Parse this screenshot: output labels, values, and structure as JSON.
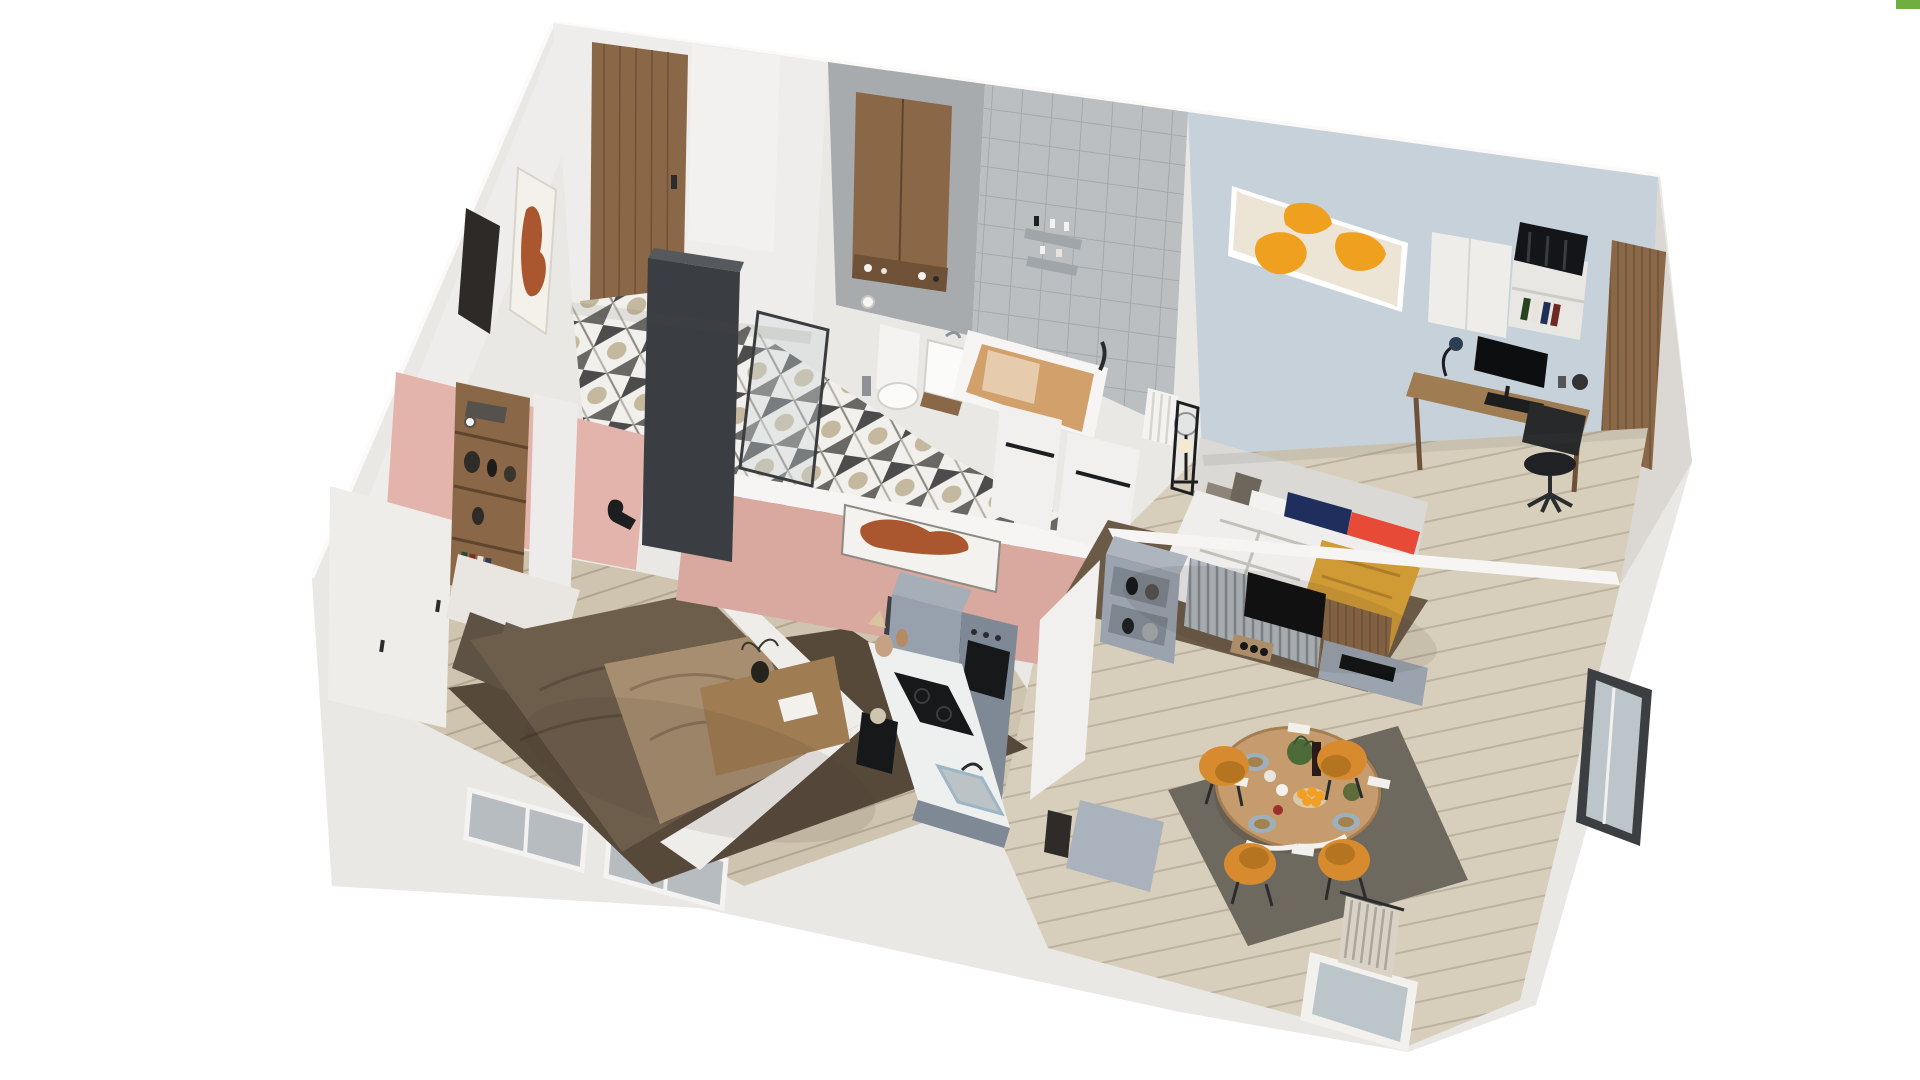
{
  "scene": {
    "type": "isometric-3d-apartment-floor-plan",
    "style": "cutaway-axonometric-interior-render",
    "rooms": [
      {
        "name": "entry-hall",
        "floor": "black-white-geometric-tile",
        "items": [
          "wooden-entry-door",
          "framed-figure-art",
          "mirror-niche",
          "dark-freestanding-wardrobe"
        ]
      },
      {
        "name": "bathroom",
        "items": [
          "wooden-wall-cabinet",
          "toiletries",
          "toilet",
          "paper-roll",
          "washbasin",
          "bathtub-tan-interior",
          "gray-tile-accent-wall",
          "metal-shelves",
          "towel-rail-half-walls",
          "glass-partition",
          "white-radiator"
        ]
      },
      {
        "name": "bedroom-secondary",
        "wall": "light-blue",
        "items": [
          "abstract-orange-wall-art",
          "upholstered-headboard-bed",
          "gray-pillows",
          "navy-pillow",
          "red-pillow",
          "mustard-throw",
          "teddy-bear",
          "glass-bedside-lamp",
          "bronze-rug",
          "wood-desk",
          "monitor",
          "keyboard",
          "desk-lamp",
          "office-chair",
          "white-cabinet",
          "open-bookshelf",
          "black-suitcase",
          "wood-slat-column"
        ]
      },
      {
        "name": "bedroom-master",
        "wall": "blush-pink",
        "items": [
          "white-wardrobes",
          "wooden-shelf-column-with-vases",
          "books",
          "wall-lamp",
          "double-bed-brown-bedding",
          "taupe-throw",
          "brown-pillows",
          "dark-brown-rug",
          "wooden-bench-console",
          "coat-hooks",
          "window-bays"
        ]
      },
      {
        "name": "kitchen",
        "items": [
          "tall-gray-cabinet",
          "built-in-oven-column",
          "marble-countertop",
          "induction-hob",
          "steel-sink",
          "coffee-machine",
          "cutting-boards",
          "clay-vases",
          "gray-island-bench",
          "black-stool"
        ]
      },
      {
        "name": "living-dining",
        "items": [
          "gray-tv-unit-open-shelves",
          "vases-and-lantern",
          "slatted-media-panel",
          "wall-mounted-tv",
          "wood-speaker",
          "media-console",
          "soundbar",
          "round-wood-dining-table",
          "four-orange-shell-chairs",
          "plate-settings",
          "fruit-bowl-oranges",
          "wine-bottle",
          "plant-centerpiece",
          "dark-gray-rug",
          "balcony-door",
          "pleated-beige-curtain",
          "east-windows"
        ]
      }
    ]
  },
  "colors": {
    "background": "#ffffff",
    "wall_light": "#eae8e4",
    "wall_lighter": "#f6f5f3",
    "wall_warm": "#efedeb",
    "wall_shadow": "#dbd8d3",
    "pink_wall": "#e2b4ab",
    "pink_wall_deep": "#d9a89f",
    "blue_wall": "#c7d1da",
    "bath_wall": "#a8abad",
    "bath_tile": "#bbbfc1",
    "wood": "#8a6746",
    "wood_dark": "#6f5138",
    "wood_desk": "#a07c52",
    "wardrobe_dark": "#3a3d41",
    "floor_living": "#d7cebc",
    "floor_bedroom": "#cfc4af",
    "rug_left_bedroom": "#57493a",
    "rug_bedroom2": "#6b5a46",
    "rug_dining": "#6e695f",
    "bed2_duvet": "#efeeec",
    "headboard": "#dbd9d5",
    "pillow_navy": "#1f2e5c",
    "pillow_red": "#e84a38",
    "pillow_gray": "#8d8579",
    "throw_mustard": "#d09a35",
    "bed1_duvet": "#6d5d4b",
    "bed1_throw": "#a78e71",
    "bed1_pillow": "#5e5245",
    "bed_frame_white": "#efedea",
    "art_cream": "#ece4d4",
    "art_orange": "#f0a01f",
    "art_terracotta": "#aa572f",
    "kitchen_gray": "#97a1ad",
    "kitchen_gray_dark": "#7f8996",
    "marble": "#eef0f0",
    "appliance_black": "#17181a",
    "tv_unit_gray": "#9aa3ae",
    "slat_gray": "#b3b9bf",
    "tv_black": "#0d0e10",
    "chair_orange": "#d78b2e",
    "chair_orange_dark": "#b5741f",
    "table_wood": "#c69c6e",
    "curtain": "#d9d3c7",
    "metal_dark": "#27282a",
    "plant_green": "#4c6b39",
    "fruit_orange": "#f2a024",
    "glass_gray": "#bcc6ca",
    "artifact_green": "#6fae3f"
  }
}
